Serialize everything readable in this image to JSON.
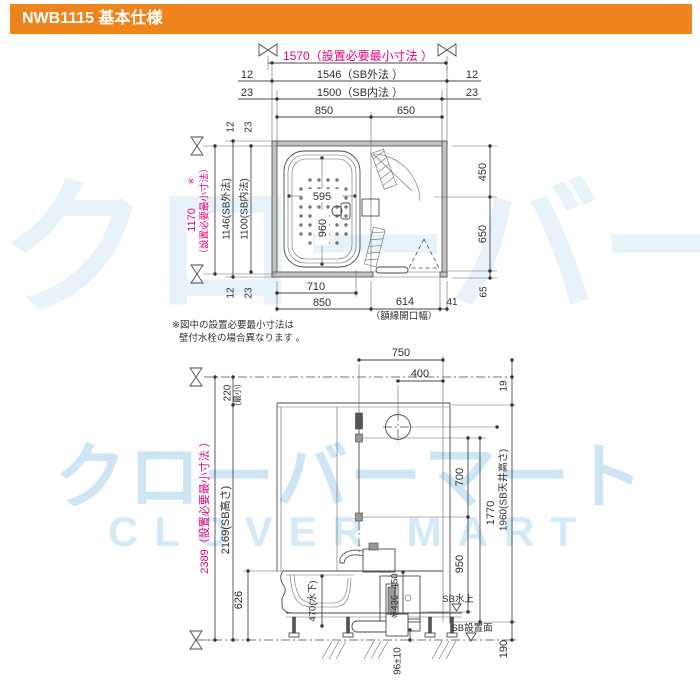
{
  "header": {
    "title": "NWB1115 基本仕様"
  },
  "colors": {
    "header_bg": "#f0841c",
    "dim_pink": "#e5007f",
    "line": "#4a4a4a",
    "watermark": "#cde4f1"
  },
  "watermark": {
    "jp": "クローバーマート",
    "en": "CLOVER MART"
  },
  "note": {
    "line1": "※図中の設置必要最小寸法は",
    "line2": "壁付水栓の場合異なります 。"
  },
  "plan": {
    "top": {
      "d1570": "1570（設置必要最小寸法 ）",
      "d12L": "12",
      "d1546": "1546（SB外法 ）",
      "d12R": "12",
      "d23L": "23",
      "d1500": "1500（SB内法 ）",
      "d23R": "23",
      "d850": "850",
      "d650": "650"
    },
    "left": {
      "d1170": "1170",
      "d1170_note": "※",
      "d1170_label": "（設置必要最小寸法）",
      "d12T": "12",
      "d23T": "23",
      "d1146": "1146(SB外法)",
      "d1100": "1100(SB内法)",
      "d12B": "12",
      "d23B": "23"
    },
    "tub": {
      "d595": "595",
      "d960": "960"
    },
    "bottom": {
      "d710": "710",
      "d850": "850",
      "d614": "614",
      "d614_label": "（額縁開口幅）",
      "d41": "41"
    },
    "right": {
      "d450": "450",
      "d650": "650",
      "d65": "65"
    }
  },
  "elevation": {
    "top": {
      "d750": "750",
      "d400": "400",
      "d19": "19"
    },
    "left": {
      "d220": "220",
      "d220_label": "(最小)",
      "d2389": "2389（設置必要最小寸法 ）",
      "d2169": "2169(SB高さ)",
      "d626": "626"
    },
    "middle": {
      "d470": "470(水下)",
      "d436": "※436~450",
      "d96": "96±10"
    },
    "right": {
      "d700": "700",
      "d950": "950",
      "d1770": "1770",
      "d1960": "1960(SB天井高さ)",
      "d190": "190",
      "sb_water": "SB水上",
      "sb_surface": "SB設置面"
    }
  }
}
